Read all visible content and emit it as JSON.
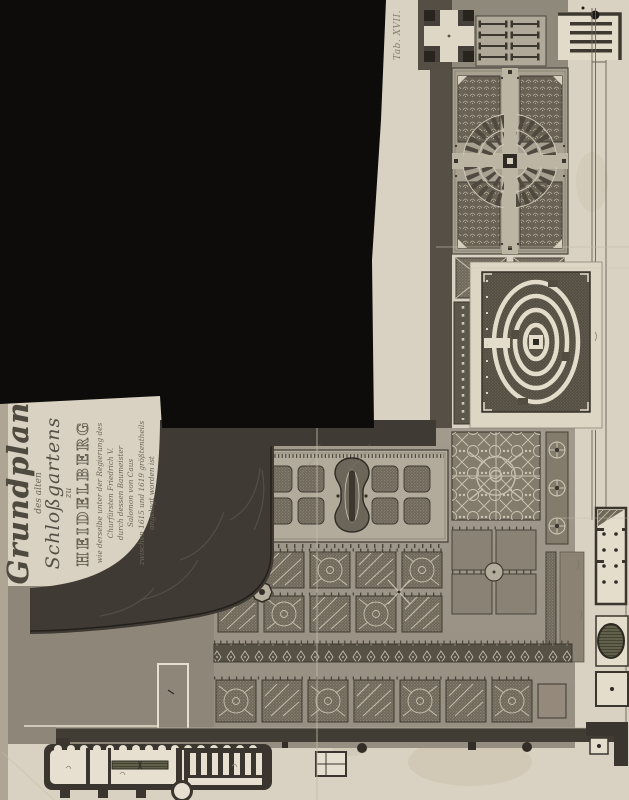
{
  "document": {
    "type": "scanned engraved garden plan",
    "plate_label": "Tab. XVII.",
    "cartouche": {
      "title_main": "Grundplan",
      "title_sub1": "des alten",
      "title_sub2": "Schloßgartens",
      "title_zu": "zu",
      "title_city": "HEIDELBERG",
      "dedication_lines": [
        "wie derselbe unter der Regierung des",
        "Churfürsten Friedrich V.",
        "durch dessen Baumeister",
        "Salomon von Caus",
        "zwischen 1615 und 1619 größtentheils",
        "angelegt worden ist"
      ]
    }
  },
  "colors": {
    "paper": "#d9d2c2",
    "ink_dark": "#3a362f",
    "plan_field": "#9c968a",
    "black_region": "#0d0c0a",
    "slope": "#3f3a33",
    "interior_white": "#e7e0d0",
    "pool_green": "#5f5e49",
    "bed_dark": "#6e6759",
    "accent_light": "#cfc8b6",
    "script_ink": "#6a645a"
  }
}
